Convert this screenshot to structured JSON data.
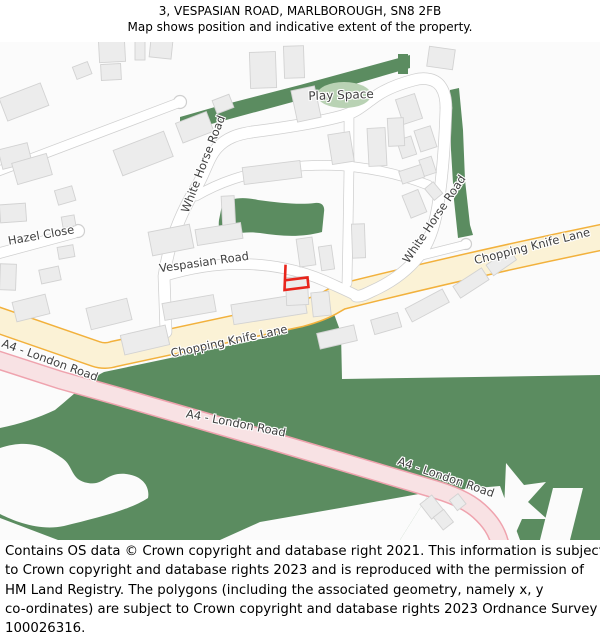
{
  "header": {
    "title": "3, VESPASIAN ROAD, MARLBOROUGH, SN8 2FB",
    "subtitle": "Map shows position and indicative extent of the property."
  },
  "labels": {
    "play_space": "Play Space",
    "white_horse_road_west": "White Horse Road",
    "white_horse_road_east": "White Horse Road",
    "hazel_close": "Hazel Close",
    "vespasian_road": "Vespasian Road",
    "chopping_knife_lane_west": "Chopping Knife Lane",
    "chopping_knife_lane_east": "Chopping Knife Lane",
    "a4_london_road_west": "A4 - London Road",
    "a4_london_road_mid": "A4 - London Road",
    "a4_london_road_east": "A4 - London Road"
  },
  "map": {
    "colors": {
      "green": "#5B8C60",
      "play": "#B9D2B4",
      "roadfill": "#FFFFFF",
      "roadcase": "#CFCFCF",
      "bldg": "#ECECEC",
      "bldgline": "#D2D2D2",
      "pinkfill": "#F8E2E4",
      "pinkcase": "#EFA3AE",
      "yelfill": "#FBF2D6",
      "yelcase": "#F2B13C",
      "red": "#E8251C",
      "mapbg": "#FBFBFB",
      "lbl": "#3F3F3F"
    }
  },
  "footer": {
    "lines": [
      "Contains OS data © Crown copyright and database right 2021. This information is subject",
      "to Crown copyright and database rights 2023 and is reproduced with the permission of",
      "HM Land Registry. The polygons (including the associated geometry, namely x, y",
      "co-ordinates) are subject to Crown copyright and database rights 2023 Ordnance Survey",
      "100026316."
    ]
  }
}
